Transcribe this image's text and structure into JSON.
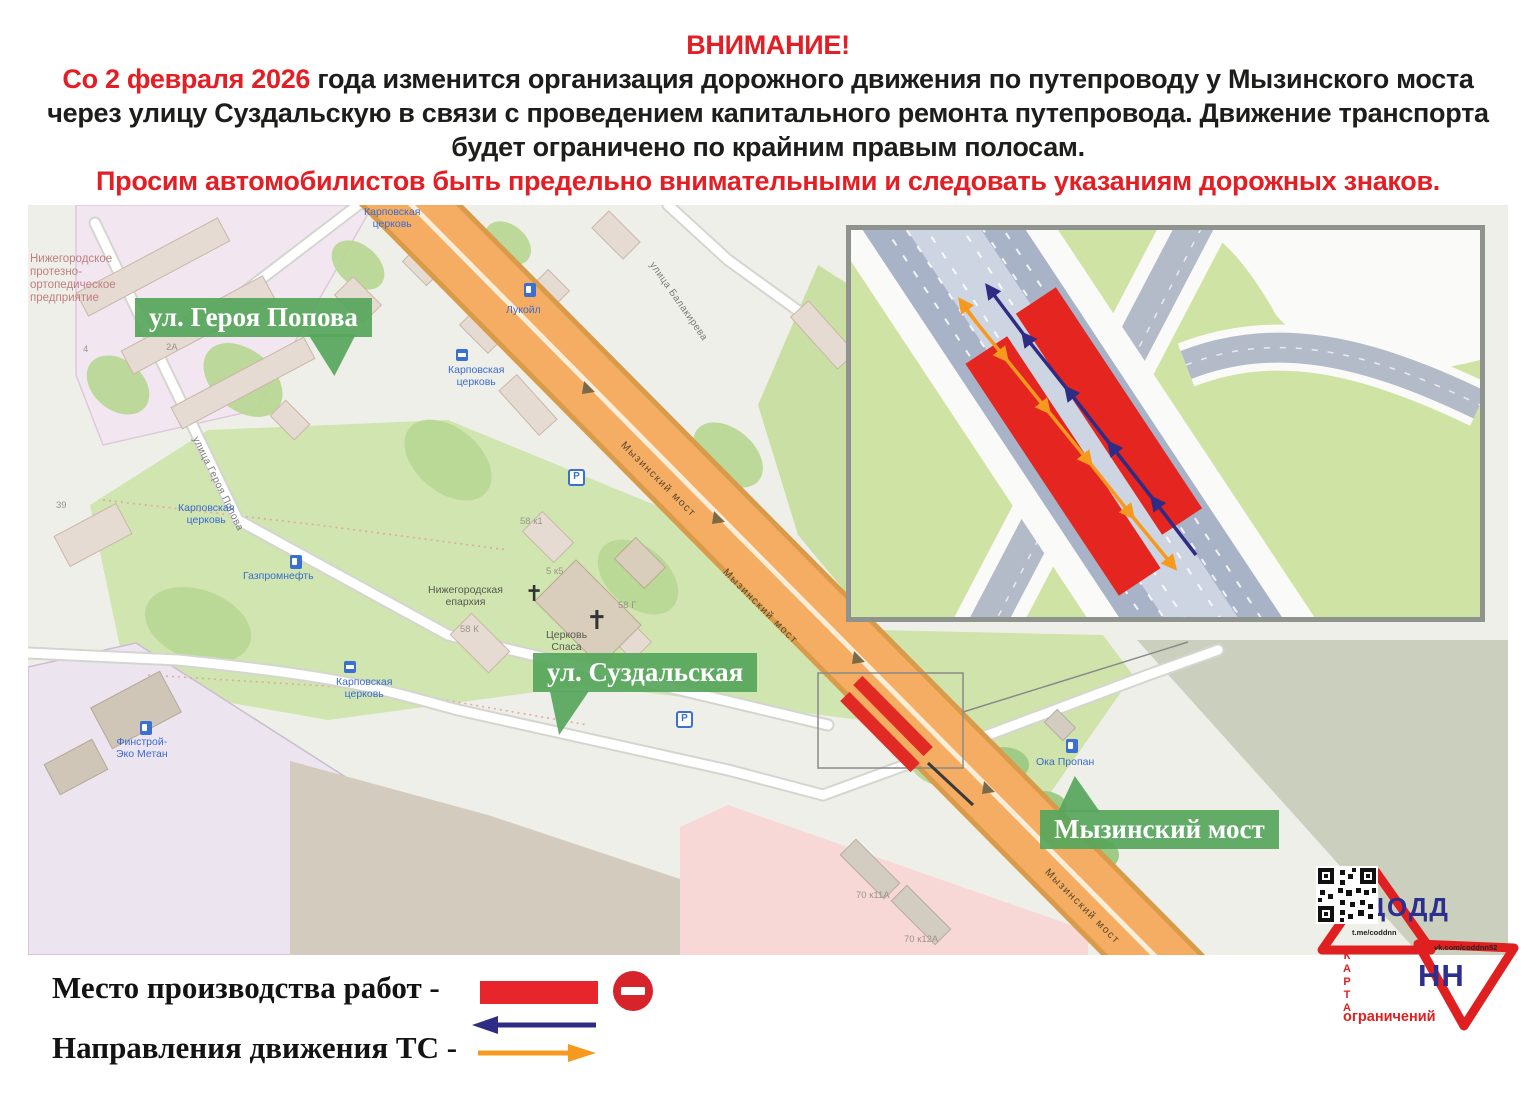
{
  "header": {
    "attention": "ВНИМАНИЕ!",
    "date_highlight": "Со 2 февраля 2026",
    "body_after_date": " года изменится организация дорожного движения по путепроводу у Мызинского моста через улицу Суздальскую в связи с проведением капитального ремонта путепровода. Движение транспорта будет ограничено по крайним правым полосам.",
    "warning": "Просим автомобилистов быть предельно внимательными и следовать указаниям дорожных знаков."
  },
  "map": {
    "callouts": [
      {
        "label": "ул. Героя Попова"
      },
      {
        "label": "ул. Суздальская"
      },
      {
        "label": "Мызинский мост"
      }
    ],
    "labels": [
      {
        "kind": "area-red",
        "text": "Нижегородское\nпротезно-\nортопедическое\nпредприятие",
        "x": 2,
        "y": 48
      },
      {
        "kind": "street",
        "text": "улица Героя Попова",
        "x": 172,
        "y": 230,
        "rot": 64
      },
      {
        "kind": "street",
        "text": "улица Балакирева",
        "x": 628,
        "y": 55,
        "rot": 55
      },
      {
        "kind": "poi-blue",
        "text": "Карповская\nцерковь",
        "x": 336,
        "y": 2
      },
      {
        "kind": "poi-blue",
        "text": "Карповская\nцерковь",
        "x": 420,
        "y": 160
      },
      {
        "kind": "poi-blue",
        "text": "Карповская\nцерковь",
        "x": 150,
        "y": 298
      },
      {
        "kind": "poi-blue",
        "text": "Карповская\nцерковь",
        "x": 308,
        "y": 472
      },
      {
        "kind": "poi-blue",
        "text": "Лукойл",
        "x": 478,
        "y": 100
      },
      {
        "kind": "poi-blue",
        "text": "Газпромнефть",
        "x": 215,
        "y": 366
      },
      {
        "kind": "poi-blue",
        "text": "Финстрой-\nЭко Метан",
        "x": 88,
        "y": 532
      },
      {
        "kind": "poi-blue",
        "text": "Ока Пропан",
        "x": 1008,
        "y": 552
      },
      {
        "kind": "poi-dark",
        "text": "Нижегородская\nепархия",
        "x": 400,
        "y": 380
      },
      {
        "kind": "poi-dark",
        "text": "Церковь\nСпаса",
        "x": 518,
        "y": 425
      },
      {
        "kind": "num",
        "text": "2А",
        "x": 138,
        "y": 138
      },
      {
        "kind": "num",
        "text": "4",
        "x": 55,
        "y": 140
      },
      {
        "kind": "num",
        "text": "39",
        "x": 28,
        "y": 296
      },
      {
        "kind": "num",
        "text": "58 к1",
        "x": 492,
        "y": 312
      },
      {
        "kind": "num",
        "text": "5 к5",
        "x": 518,
        "y": 362
      },
      {
        "kind": "num",
        "text": "58 Г",
        "x": 590,
        "y": 396
      },
      {
        "kind": "num",
        "text": "58 К",
        "x": 432,
        "y": 420
      },
      {
        "kind": "num",
        "text": "70 к11А",
        "x": 828,
        "y": 686
      },
      {
        "kind": "num",
        "text": "70 к12А",
        "x": 876,
        "y": 730
      },
      {
        "kind": "road-label",
        "text": "Мызинский мост",
        "x": 598,
        "y": 235,
        "rot": 45
      },
      {
        "kind": "road-label",
        "text": "Мызинский мост",
        "x": 700,
        "y": 362,
        "rot": 45
      },
      {
        "kind": "road-label",
        "text": "Мызинский мост",
        "x": 1022,
        "y": 662,
        "rot": 45
      }
    ],
    "icons": [
      {
        "name": "fuel-icon",
        "x": 496,
        "y": 78
      },
      {
        "name": "fuel-icon",
        "x": 262,
        "y": 350
      },
      {
        "name": "fuel-icon",
        "x": 112,
        "y": 516
      },
      {
        "name": "fuel-icon",
        "x": 1038,
        "y": 534
      },
      {
        "name": "parking-icon",
        "x": 540,
        "y": 264
      },
      {
        "name": "parking-icon",
        "x": 648,
        "y": 506
      },
      {
        "name": "bus-icon",
        "x": 428,
        "y": 144
      },
      {
        "name": "bus-icon",
        "x": 316,
        "y": 456
      }
    ]
  },
  "legend": {
    "work_zone_label": "Место производства работ -",
    "directions_label": "Направления движения ТС -"
  },
  "logo": {
    "org_top": "ЦОДД",
    "org_bottom": "НН",
    "telegram": "t.me/coddnn",
    "vk": "vk.com/coddnn52",
    "map_word": "КАРТА",
    "restrictions_word": "ограничений"
  },
  "colors": {
    "accent_red": "#e31e24",
    "green_label": "#56a65b",
    "road_orange": "#f4ad62",
    "work_zone_red": "#e5251f",
    "arrow_blue": "#2e2c85",
    "arrow_orange": "#f59a1f",
    "logo_red": "#e02020",
    "logo_blue": "#2d2f8e"
  }
}
